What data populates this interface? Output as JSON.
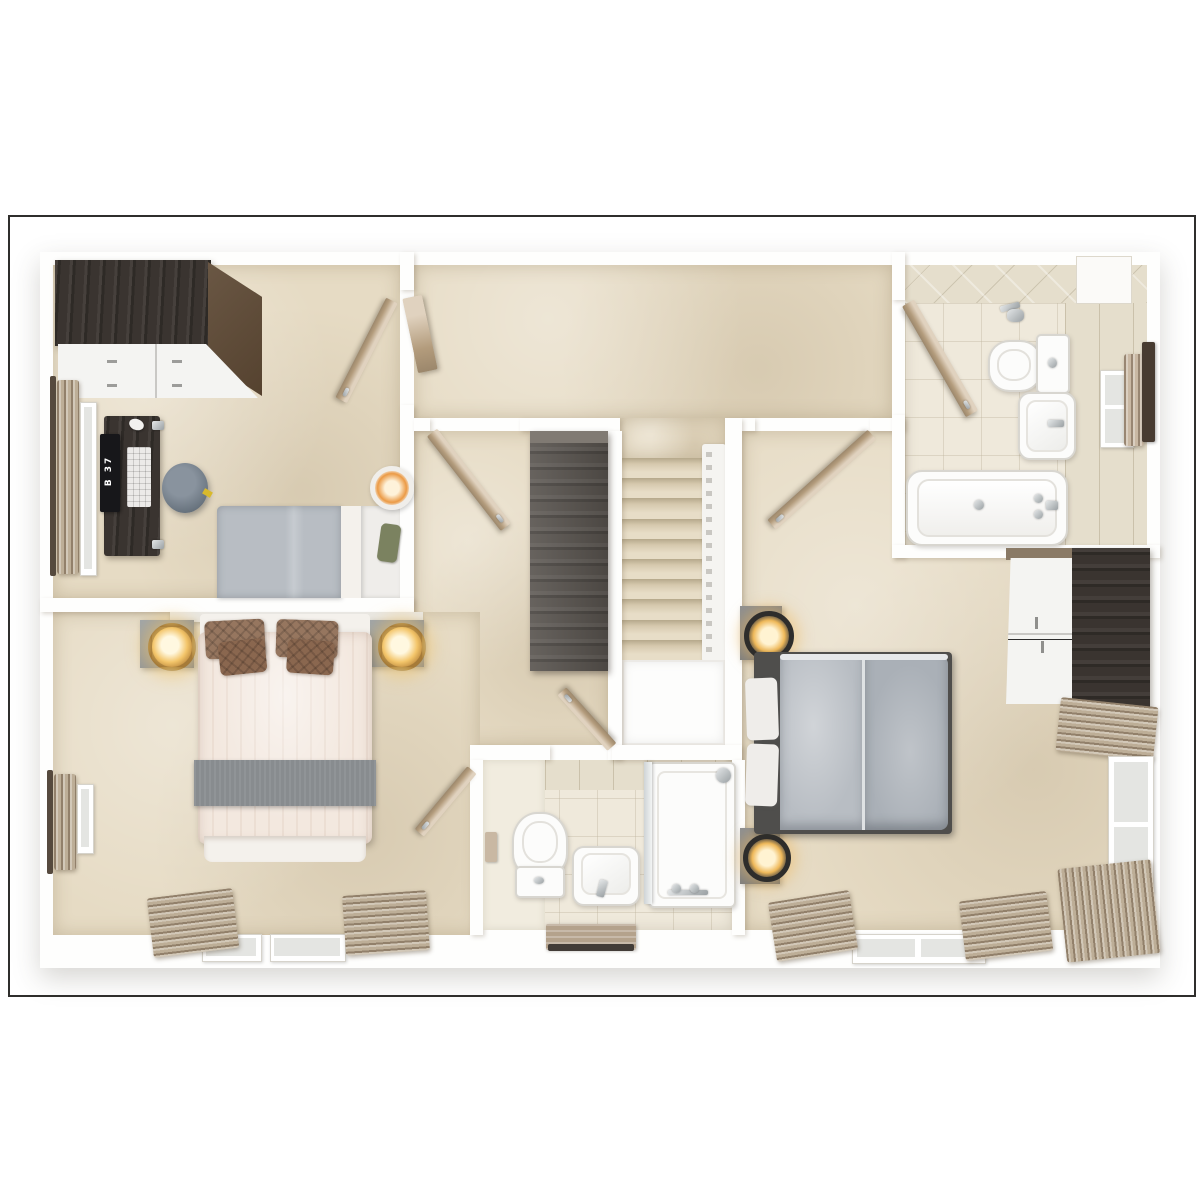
{
  "meta": {
    "type": "3d floor plan render",
    "view": "top-down dollhouse",
    "rendering": "photorealistic architectural visualization"
  },
  "desk_monitor": {
    "screen_text": "B 37"
  },
  "palette": {
    "page_bg": "#ffffff",
    "frame_line": "#2f2e2c",
    "wall": "#fefefd",
    "carpet": "#e6dbc4",
    "tile": "#efe9db",
    "tile_band": "#e5decc",
    "dark_wood": "#3a3430",
    "center_wood": "#56514c",
    "side_wood": "#6a5744",
    "door_wood": "#c7ad8a",
    "white_face": "#f4f4f2",
    "chrome": "#b6b9bb",
    "fixture": "#fcfcfb",
    "fixture_line": "#d8d6d0",
    "glass": "#e4e5e2",
    "duvet_gray": "#b8bdc3",
    "duvet_gray_dark": "#aab0b7",
    "duvet_cream": "#f3e8df",
    "sheet": "#f4f1ec",
    "runner": "#888c8f",
    "pillow_brown": "#96765f",
    "pillow_white": "#efedea",
    "green_pillow": "#7b8260",
    "headboard": "#e9e7e2",
    "nightstand": "#9fa5a9",
    "nightstand_dark": "#85878a",
    "lamp_gold": "#c59244",
    "lamp_glow": "#f3c56a",
    "lamp_black": "#2e2d2b",
    "curtain": "#bdae97",
    "rail_dark": "#564a3e",
    "stair_hi": "#e7ddc7",
    "stair_lo": "#b5a88b",
    "pouf": "#6b7681",
    "mat": "#b4a28c",
    "mat_edge": "#423c37",
    "towel": "#c9b8a3",
    "void_line": "#eceae6"
  }
}
